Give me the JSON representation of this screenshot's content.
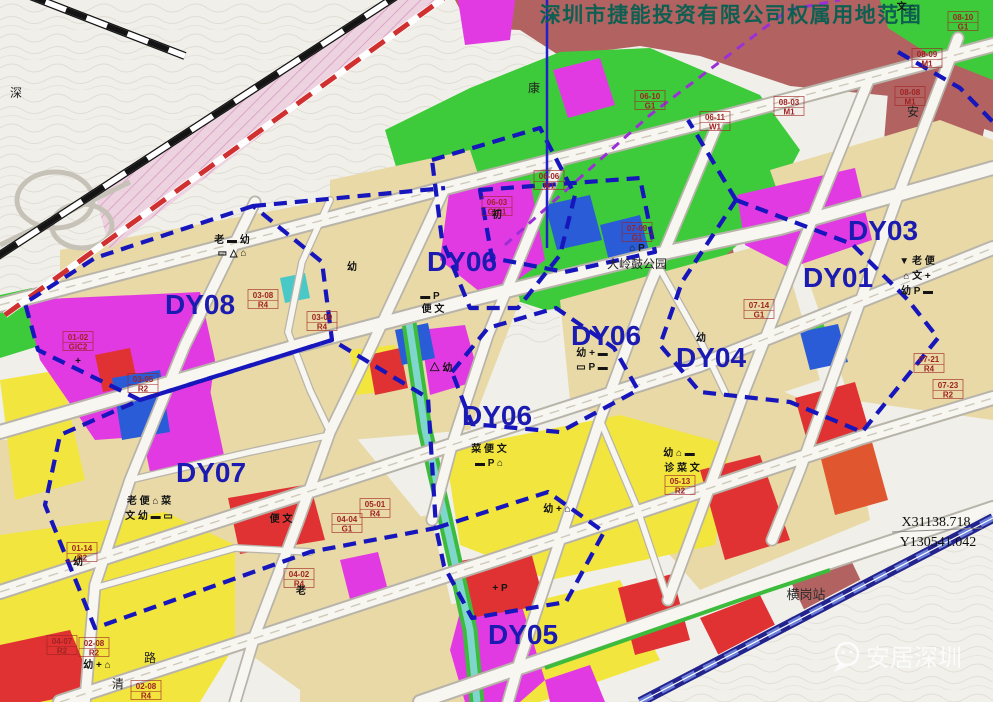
{
  "title": {
    "text": "深圳市捷能投资有限公司权属用地范围",
    "color": "#0e5f52"
  },
  "annotations": {
    "coordinate_x": "X31138.718",
    "coordinate_y": "Y130541.042",
    "station": "横岗站",
    "watermark": "安居深圳"
  },
  "palette": {
    "residential_tan": "#e8d9a6",
    "residential_yellow": "#f2e53e",
    "commercial_magenta": "#e23ae2",
    "park_green": "#3ecb3b",
    "industrial_brick": "#b26361",
    "red_zone": "#e03232",
    "special_blue": "#2a5cd8",
    "canal_teal": "#7fd6cd",
    "boundary_blue": "#1616bc",
    "district_label_blue": "#1b1bb2",
    "metro_purple": "#9b2fd6"
  },
  "map": {
    "district_labels": [
      {
        "text": "DY08",
        "x": 200,
        "y": 314
      },
      {
        "text": "DY06",
        "x": 462,
        "y": 271
      },
      {
        "text": "DY06",
        "x": 606,
        "y": 345
      },
      {
        "text": "DY06",
        "x": 497,
        "y": 425
      },
      {
        "text": "DY03",
        "x": 883,
        "y": 240
      },
      {
        "text": "DY01",
        "x": 838,
        "y": 287
      },
      {
        "text": "DY04",
        "x": 711,
        "y": 367
      },
      {
        "text": "DY07",
        "x": 211,
        "y": 482
      },
      {
        "text": "DY05",
        "x": 523,
        "y": 644
      }
    ],
    "place_labels": [
      {
        "text": "大岭鼓公园",
        "x": 637,
        "y": 268,
        "s": 13
      },
      {
        "text": "深",
        "x": 16,
        "y": 97
      },
      {
        "text": "康",
        "x": 534,
        "y": 92
      },
      {
        "text": "安",
        "x": 913,
        "y": 116
      },
      {
        "text": "清",
        "x": 118,
        "y": 688
      },
      {
        "text": "路",
        "x": 150,
        "y": 662
      }
    ],
    "parcel_codes": [
      {
        "code": "03-08",
        "zone": "R4",
        "x": 263,
        "y": 298
      },
      {
        "code": "03-09",
        "zone": "R4",
        "x": 322,
        "y": 320
      },
      {
        "code": "01-02",
        "zone": "GIC2",
        "x": 78,
        "y": 340
      },
      {
        "code": "03-05",
        "zone": "R2",
        "x": 143,
        "y": 382
      },
      {
        "code": "07-09",
        "zone": "G1",
        "x": 637,
        "y": 231
      },
      {
        "code": "06-10",
        "zone": "G1",
        "x": 650,
        "y": 99
      },
      {
        "code": "06-11",
        "zone": "W1",
        "x": 715,
        "y": 120
      },
      {
        "code": "08-03",
        "zone": "M1",
        "x": 789,
        "y": 105
      },
      {
        "code": "08-10",
        "zone": "G1",
        "x": 963,
        "y": 20
      },
      {
        "code": "08-09",
        "zone": "M1",
        "x": 927,
        "y": 57
      },
      {
        "code": "08-08",
        "zone": "M1",
        "x": 910,
        "y": 95
      },
      {
        "code": "07-14",
        "zone": "G1",
        "x": 759,
        "y": 308
      },
      {
        "code": "07-21",
        "zone": "R4",
        "x": 929,
        "y": 362
      },
      {
        "code": "07-23",
        "zone": "R2",
        "x": 948,
        "y": 388
      },
      {
        "code": "05-13",
        "zone": "R2",
        "x": 680,
        "y": 484
      },
      {
        "code": "01-14",
        "zone": "R2",
        "x": 82,
        "y": 551
      },
      {
        "code": "02-08",
        "zone": "R2",
        "x": 94,
        "y": 646
      },
      {
        "code": "02-08",
        "zone": "R4",
        "x": 146,
        "y": 689
      },
      {
        "code": "04-02",
        "zone": "R4",
        "x": 299,
        "y": 577
      },
      {
        "code": "04-04",
        "zone": "G1",
        "x": 347,
        "y": 522
      },
      {
        "code": "05-01",
        "zone": "R4",
        "x": 375,
        "y": 507
      },
      {
        "code": "04-07",
        "zone": "R2",
        "x": 62,
        "y": 644
      },
      {
        "code": "06-06",
        "zone": "M1",
        "x": 549,
        "y": 179
      },
      {
        "code": "06-03",
        "zone": "GIC1",
        "x": 497,
        "y": 205
      }
    ],
    "facility_labels": [
      {
        "text": "老 ▬ 幼",
        "x": 232,
        "y": 243
      },
      {
        "text": "▭ △ ⌂",
        "x": 232,
        "y": 256
      },
      {
        "text": "幼",
        "x": 352,
        "y": 270
      },
      {
        "text": "▬ P",
        "x": 430,
        "y": 299
      },
      {
        "text": "便 文",
        "x": 433,
        "y": 312
      },
      {
        "text": "初",
        "x": 497,
        "y": 218
      },
      {
        "text": "幼 + ▬",
        "x": 592,
        "y": 356
      },
      {
        "text": "▭ P ▬",
        "x": 592,
        "y": 370
      },
      {
        "text": "幼",
        "x": 701,
        "y": 341
      },
      {
        "text": "▼ 老 便",
        "x": 917,
        "y": 264
      },
      {
        "text": "⌂ 文 +",
        "x": 917,
        "y": 279
      },
      {
        "text": "幼 P ▬",
        "x": 917,
        "y": 294
      },
      {
        "text": "菜 便 文",
        "x": 489,
        "y": 452
      },
      {
        "text": "▬ P ⌂",
        "x": 489,
        "y": 466
      },
      {
        "text": "幼 ⌂ ▬",
        "x": 679,
        "y": 456
      },
      {
        "text": "诊 菜 文",
        "x": 682,
        "y": 471
      },
      {
        "text": "老 便 ⌂ 菜",
        "x": 149,
        "y": 504
      },
      {
        "text": "文 幼 ▬ ▭",
        "x": 149,
        "y": 519
      },
      {
        "text": "幼 + ⌂",
        "x": 97,
        "y": 668
      },
      {
        "text": "幼",
        "x": 78,
        "y": 565
      },
      {
        "text": "便 文",
        "x": 281,
        "y": 522
      },
      {
        "text": "老",
        "x": 301,
        "y": 594
      },
      {
        "text": "幼 + ⌂",
        "x": 557,
        "y": 512
      },
      {
        "text": "△ 幼",
        "x": 441,
        "y": 371
      },
      {
        "text": "文 ⌂",
        "x": 906,
        "y": 10
      },
      {
        "text": "⌂ P",
        "x": 637,
        "y": 251
      },
      {
        "text": "+ P",
        "x": 500,
        "y": 591
      },
      {
        "text": "+",
        "x": 78,
        "y": 364,
        "s": 24
      }
    ]
  }
}
